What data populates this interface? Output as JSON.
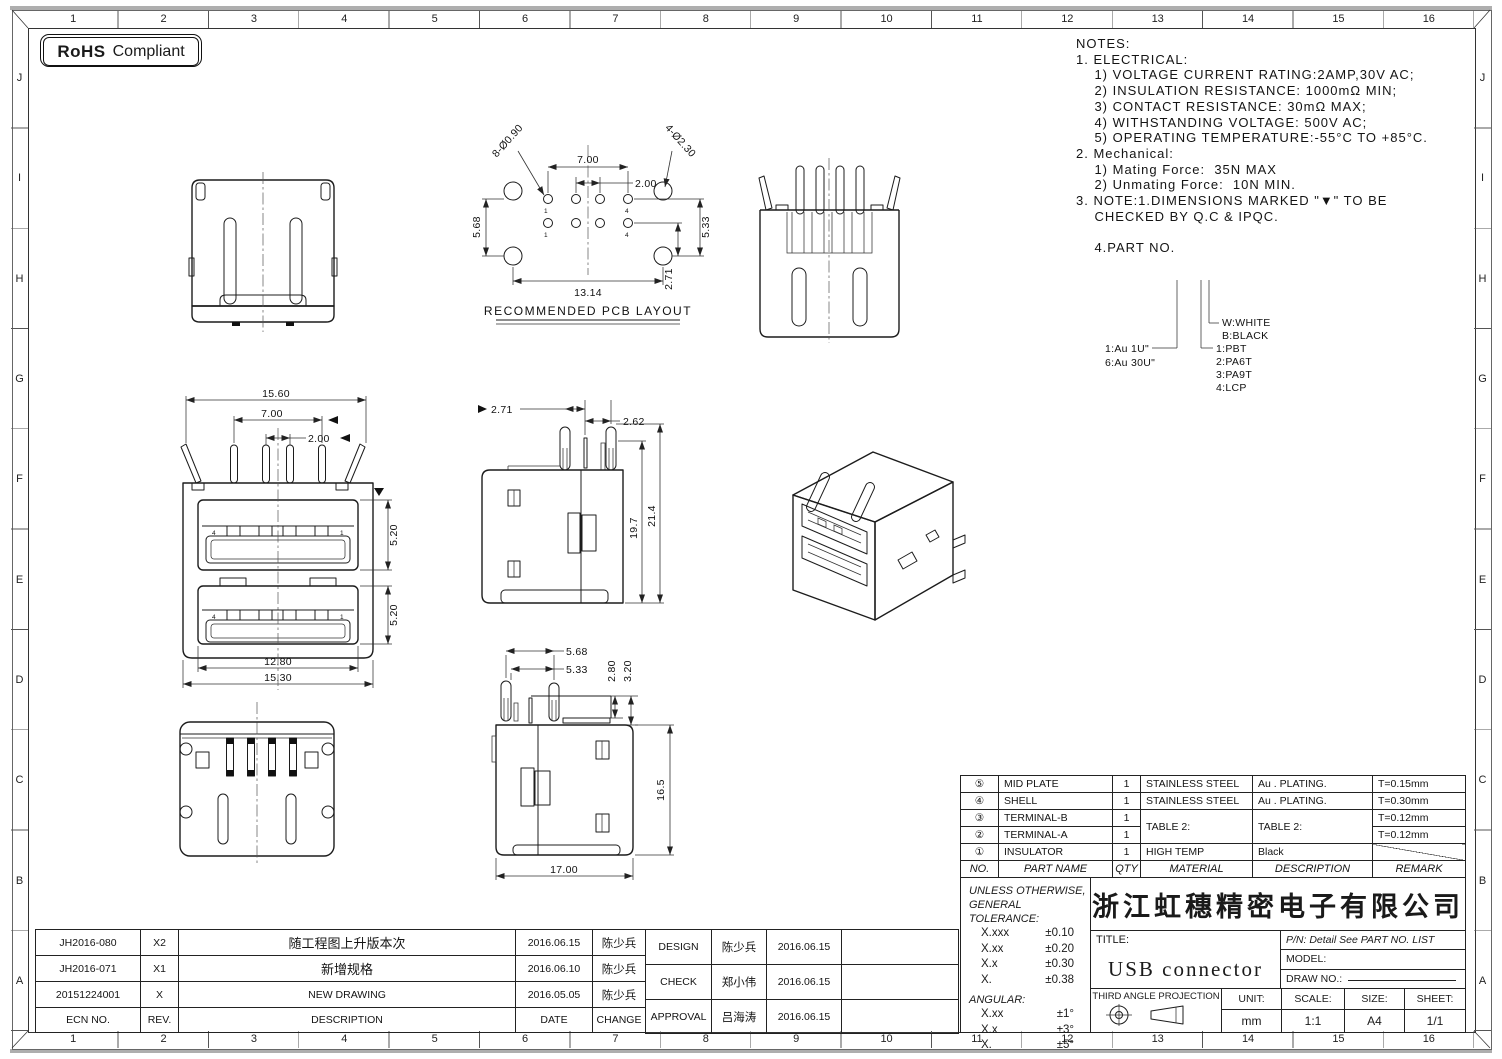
{
  "frame": {
    "cols": [
      "1",
      "2",
      "3",
      "4",
      "5",
      "6",
      "7",
      "8",
      "9",
      "10",
      "11",
      "12",
      "13",
      "14",
      "15",
      "16"
    ],
    "rows": [
      "J",
      "I",
      "H",
      "G",
      "F",
      "E",
      "D",
      "C",
      "B",
      "A"
    ]
  },
  "badge": {
    "bold": "RoHS",
    "text": "Compliant"
  },
  "notes": {
    "lines": [
      "NOTES:",
      "1. ELECTRICAL:",
      "    1) VOLTAGE CURRENT RATING:2AMP,30V AC;",
      "    2) INSULATION RESISTANCE: 1000mΩ MIN;",
      "    3) CONTACT RESISTANCE: 30mΩ MAX;",
      "    4) WITHSTANDING VOLTAGE: 500V AC;",
      "    5) OPERATING TEMPERATURE:-55°C TO +85°C.",
      "2. Mechanical:",
      "    1) Mating Force:  35N MAX",
      "    2) Unmating Force:  10N MIN.",
      "3. NOTE:1.DIMENSIONS MARKED \"▼\" TO BE",
      "    CHECKED BY Q.C & IPQC.",
      " ",
      "    4.PART NO."
    ]
  },
  "part_tree": {
    "au1": "1:Au 1U\"",
    "au6": "6:Au 30U\"",
    "white": "W:WHITE",
    "black": "B:BLACK",
    "pbt": "1:PBT",
    "pa6t": "2:PA6T",
    "pa9t": "3:PA9T",
    "lcp": "4:LCP"
  },
  "pcb": {
    "title": "RECOMMENDED PCB LAYOUT",
    "dim_700": "7.00",
    "dim_200": "2.00",
    "dim_holes_small": "8-Ø0.90",
    "dim_holes_big": "4-Ø2.30",
    "dim_568": "5.68",
    "dim_533": "5.33",
    "dim_1314": "13.14",
    "dim_271": "2.71",
    "pin1": "1",
    "pin4": "4"
  },
  "front": {
    "dim_1560": "15.60",
    "dim_700": "7.00",
    "dim_200": "2.00",
    "dim_520a": "5.20",
    "dim_520b": "5.20",
    "dim_1280": "12.80",
    "dim_1530": "15.30",
    "pin4": "4",
    "pin1": "1"
  },
  "side": {
    "dim_271": "2.71",
    "dim_262": "2.62",
    "dim_197": "19.7",
    "dim_214": "21.4"
  },
  "bottom_side": {
    "dim_568": "5.68",
    "dim_533": "5.33",
    "dim_280": "2.80",
    "dim_320": "3.20",
    "dim_165": "16.5",
    "dim_1700": "17.00"
  },
  "bom": {
    "headers": {
      "no": "NO.",
      "name": "PART NAME",
      "qty": "QTY",
      "material": "MATERIAL",
      "desc": "DESCRIPTION",
      "remark": "REMARK"
    },
    "rows": [
      {
        "no": "⑤",
        "name": "MID PLATE",
        "qty": "1",
        "material": "STAINLESS STEEL",
        "desc": "Au . PLATING.",
        "remark": "T=0.15mm"
      },
      {
        "no": "④",
        "name": "SHELL",
        "qty": "1",
        "material": "STAINLESS STEEL",
        "desc": "Au . PLATING.",
        "remark": "T=0.30mm"
      },
      {
        "no": "③",
        "name": "TERMINAL-B",
        "qty": "1",
        "material": "TABLE 2:",
        "desc": "TABLE 2:",
        "remark": "T=0.12mm"
      },
      {
        "no": "②",
        "name": "TERMINAL-A",
        "qty": "1",
        "material": "",
        "desc": "",
        "remark": "T=0.12mm"
      },
      {
        "no": "①",
        "name": "INSULATOR",
        "qty": "1",
        "material": "HIGH TEMP",
        "desc": "Black",
        "remark": ""
      }
    ]
  },
  "tolerance": {
    "l1": "UNLESS OTHERWISE,",
    "l2": "GENERAL TOLERANCE:",
    "rows": [
      {
        "k": "X.xxx",
        "v": "±0.10"
      },
      {
        "k": "X.xx",
        "v": "±0.20"
      },
      {
        "k": "X.x",
        "v": "±0.30"
      },
      {
        "k": "X.",
        "v": "±0.38"
      }
    ],
    "angular": "ANGULAR:",
    "angular_rows": [
      {
        "k": "X.xx",
        "v": "±1°"
      },
      {
        "k": "X.x",
        "v": "±3°"
      },
      {
        "k": "X.",
        "v": "±5°"
      }
    ]
  },
  "title_block": {
    "company": "浙江虹穗精密电子有限公司",
    "title_label": "TITLE:",
    "title": "USB connector",
    "pn": "P/N: Detail See PART NO. LIST",
    "model_label": "MODEL:",
    "draw_label": "DRAW NO.:",
    "projection": "THIRD ANGLE PROJECTION",
    "unit_label": "UNIT:",
    "unit": "mm",
    "scale_label": "SCALE:",
    "scale": "1:1",
    "size_label": "SIZE:",
    "size": "A4",
    "sheet_label": "SHEET:",
    "sheet": "1/1"
  },
  "revisions": {
    "headers": {
      "ecn": "ECN NO.",
      "rev": "REV.",
      "desc": "DESCRIPTION",
      "date": "DATE",
      "change": "CHANGE"
    },
    "rows": [
      {
        "ecn": "JH2016-080",
        "rev": "X2",
        "desc": "随工程图上升版本次",
        "date": "2016.06.15",
        "change": "陈少兵"
      },
      {
        "ecn": "JH2016-071",
        "rev": "X1",
        "desc": "新增规格",
        "date": "2016.06.10",
        "change": "陈少兵"
      },
      {
        "ecn": "20151224001",
        "rev": "X",
        "desc": "NEW DRAWING",
        "date": "2016.05.05",
        "change": "陈少兵"
      }
    ]
  },
  "approvals": {
    "rows": [
      {
        "role": "DESIGN",
        "name": "陈少兵",
        "date": "2016.06.15"
      },
      {
        "role": "CHECK",
        "name": "郑小伟",
        "date": "2016.06.15"
      },
      {
        "role": "APPROVAL",
        "name": "吕海涛",
        "date": "2016.06.15"
      }
    ]
  }
}
